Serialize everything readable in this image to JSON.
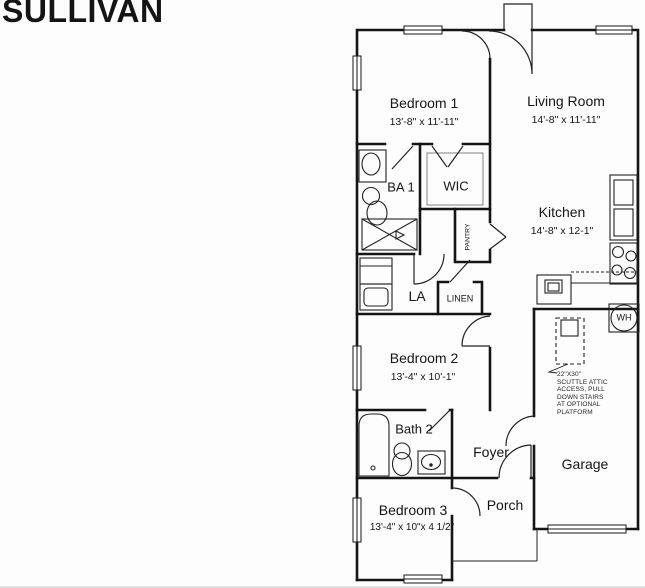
{
  "plan": {
    "title": "SULLIVAN"
  },
  "rooms": {
    "bedroom1": {
      "name": "Bedroom 1",
      "dims": "13'-8\" x 11'-11\""
    },
    "living": {
      "name": "Living Room",
      "dims": "14'-8\" x 11'-11\""
    },
    "kitchen": {
      "name": "Kitchen",
      "dims": "14'-8\" x 12-1\""
    },
    "bedroom2": {
      "name": "Bedroom 2",
      "dims": "13'-4\" x 10'-1\""
    },
    "bedroom3": {
      "name": "Bedroom 3",
      "dims": "13'-4\" x 10\"x 4 1/2\""
    },
    "ba1": {
      "name": "BA 1"
    },
    "wic": {
      "name": "WIC"
    },
    "pantry": {
      "name": "PANTRY"
    },
    "la": {
      "name": "LA"
    },
    "linen": {
      "name": "LINEN"
    },
    "bath2": {
      "name": "Bath 2"
    },
    "foyer": {
      "name": "Foyer"
    },
    "garage": {
      "name": "Garage"
    },
    "porch": {
      "name": "Porch"
    }
  },
  "fixtures": {
    "water_heater": "WH"
  },
  "annotations": {
    "attic_lines": [
      "22\"X30\"",
      "SCUTTLE ATTIC",
      "ACCESS, PULL",
      "DOWN STAIRS",
      "AT OPTIONAL",
      "PLATFORM"
    ]
  },
  "colors": {
    "wall": "#151515",
    "text": "#151515",
    "background": "#fdfdfd"
  }
}
